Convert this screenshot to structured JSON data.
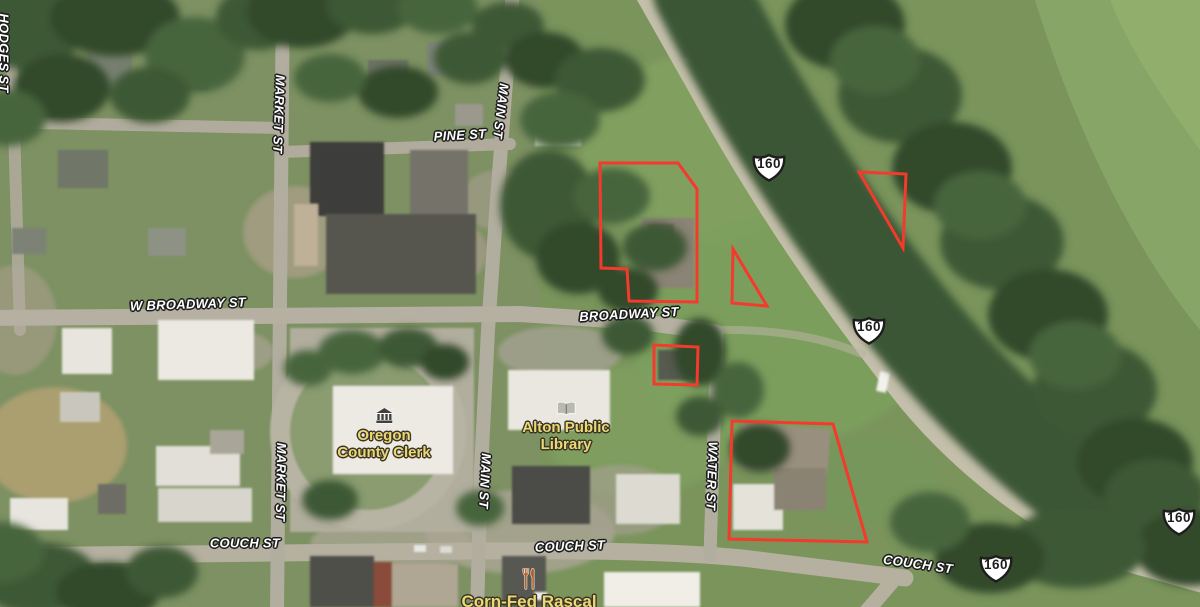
{
  "map": {
    "type": "satellite",
    "street_labels": [
      {
        "text": "HODGES ST",
        "x": 4,
        "y": 53,
        "rot": 90
      },
      {
        "text": "MARKET ST",
        "x": 279,
        "y": 114,
        "rot": 92
      },
      {
        "text": "MAIN ST",
        "x": 501,
        "y": 111,
        "rot": 97
      },
      {
        "text": "PINE ST",
        "x": 460,
        "y": 135,
        "rot": -3
      },
      {
        "text": "W BROADWAY ST",
        "x": 188,
        "y": 304,
        "rot": -2
      },
      {
        "text": "BROADWAY ST",
        "x": 629,
        "y": 314,
        "rot": -3
      },
      {
        "text": "MARKET ST",
        "x": 281,
        "y": 482,
        "rot": 91
      },
      {
        "text": "MAIN ST",
        "x": 485,
        "y": 481,
        "rot": 93
      },
      {
        "text": "WATER ST",
        "x": 712,
        "y": 476,
        "rot": 92
      },
      {
        "text": "COUCH ST",
        "x": 245,
        "y": 543,
        "rot": 0
      },
      {
        "text": "COUCH ST",
        "x": 570,
        "y": 546,
        "rot": -2
      },
      {
        "text": "COUCH ST",
        "x": 918,
        "y": 564,
        "rot": 8
      }
    ],
    "route_shields": [
      {
        "label": "160",
        "x": 769,
        "y": 167
      },
      {
        "label": "160",
        "x": 869,
        "y": 330
      },
      {
        "label": "160",
        "x": 996,
        "y": 568
      },
      {
        "label": "160",
        "x": 1179,
        "y": 521
      }
    ],
    "poi_labels": [
      {
        "name": "Oregon County Clerk",
        "icon": "courthouse-icon",
        "lines": [
          "Oregon",
          "County Clerk"
        ],
        "x": 384,
        "y": 407,
        "color": "#ecd976"
      },
      {
        "name": "Alton Public Library",
        "icon": "book-icon",
        "lines": [
          "Alton Public",
          "Library"
        ],
        "x": 566,
        "y": 401,
        "color": "#ecd976"
      },
      {
        "name": "Corn-Fed Rascal",
        "icon": "restaurant-icon",
        "lines": [
          "Corn-Fed Rascal"
        ],
        "x": 529,
        "y": 568,
        "color": "#ecd976",
        "big": true
      }
    ],
    "parcel_outlines": {
      "color": "#f5392c",
      "stroke_width": 3,
      "polygons": [
        {
          "id": "parcel-1",
          "points": [
            [
              600,
              163
            ],
            [
              678,
              163
            ],
            [
              697,
              189
            ],
            [
              697,
              302
            ],
            [
              629,
              301
            ],
            [
              627,
              269
            ],
            [
              601,
              268
            ]
          ]
        },
        {
          "id": "parcel-2",
          "points": [
            [
              733,
              249
            ],
            [
              732,
              303
            ],
            [
              767,
              306
            ]
          ]
        },
        {
          "id": "parcel-3",
          "points": [
            [
              859,
              172
            ],
            [
              906,
              174
            ],
            [
              903,
              248
            ]
          ]
        },
        {
          "id": "parcel-4",
          "points": [
            [
              654,
              345
            ],
            [
              698,
              347
            ],
            [
              697,
              385
            ],
            [
              654,
              384
            ]
          ]
        },
        {
          "id": "parcel-5",
          "points": [
            [
              732,
              421
            ],
            [
              833,
              424
            ],
            [
              867,
              542
            ],
            [
              729,
              539
            ]
          ]
        }
      ]
    }
  }
}
